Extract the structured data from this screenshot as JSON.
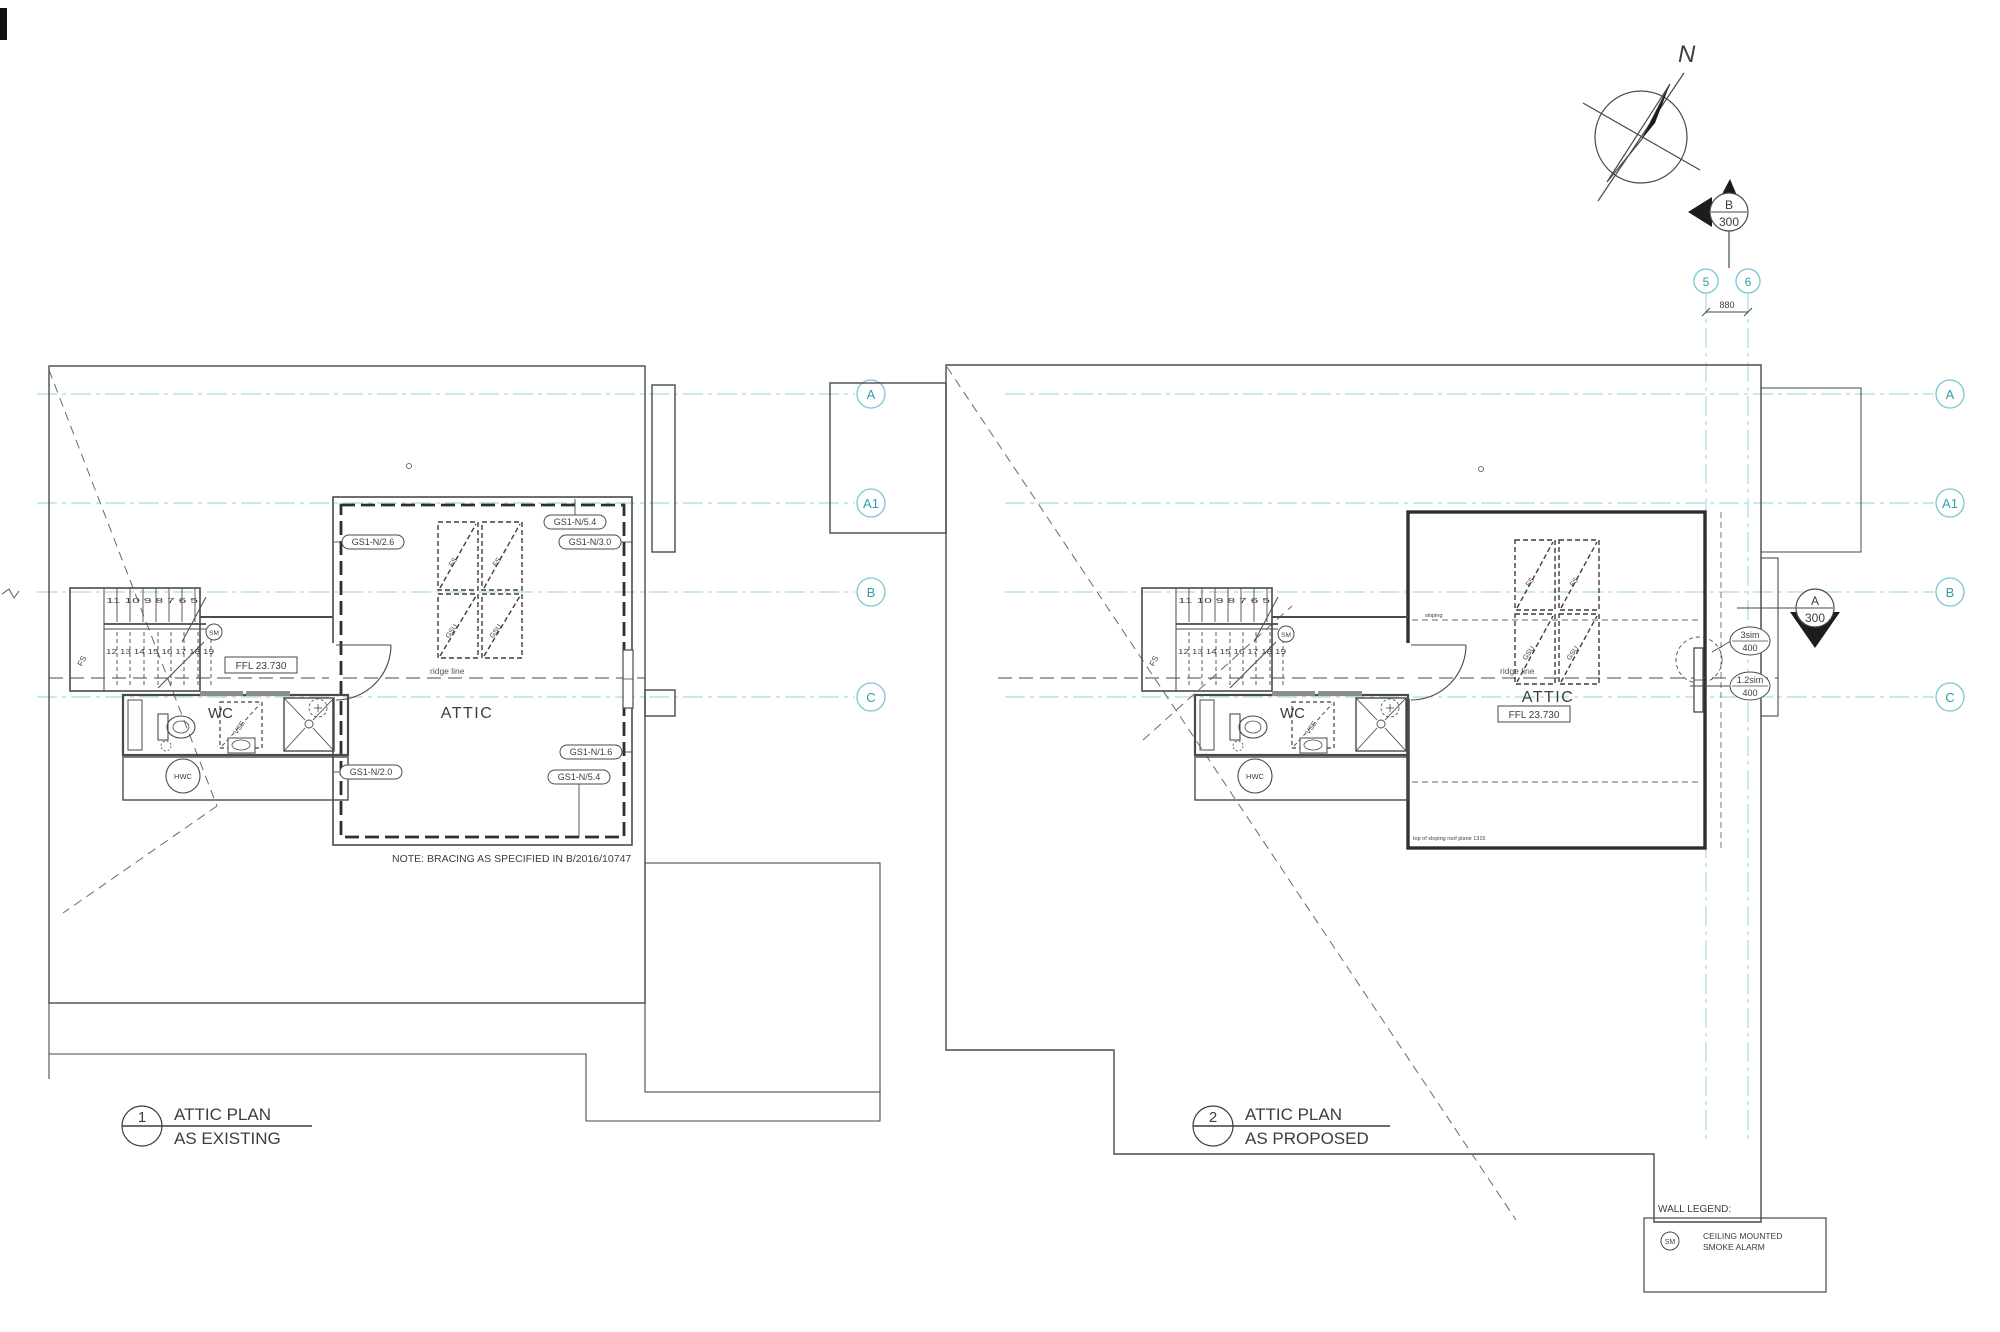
{
  "drawing": {
    "line_color": "#4a4a4a",
    "grid_line_color": "#a8dde2",
    "grid_bubble_color": "#79c7cf",
    "grid_text_color": "#2e9fae"
  },
  "north": {
    "label": "N"
  },
  "markers": {
    "b": {
      "letter": "B",
      "number": "300"
    },
    "a": {
      "letter": "A",
      "number": "300"
    }
  },
  "grids": {
    "horizontal": [
      {
        "label": "A"
      },
      {
        "label": "A1"
      },
      {
        "label": "B"
      },
      {
        "label": "C"
      }
    ],
    "vertical": [
      {
        "label": "5"
      },
      {
        "label": "6"
      }
    ],
    "dim_5_6": "880"
  },
  "plans": {
    "left": {
      "title_num": "1",
      "title_line1": "ATTIC PLAN",
      "title_line2": "AS EXISTING",
      "room": "ATTIC",
      "ffl": "FFL 23.730",
      "ridge": "ridge line",
      "wc": "WC",
      "hwc": "HWC",
      "sm": "SM",
      "stair_top": "11 10 9 8 7 6 5",
      "stair_bottom": "12 13 14 15 16 17 18 19",
      "stair_skylight": "FS",
      "skylight_fs": "FS",
      "skylight_gsu": "GSU",
      "wc_skylight": "VSE",
      "note": "NOTE: BRACING AS SPECIFIED IN B/2016/10747",
      "bracing_labels": {
        "left": "GS1-N/2.6",
        "top": "GS1-N/5.4",
        "right": "GS1-N/3.0",
        "bottom_right_upper": "GS1-N/1.6",
        "bottom_right_lower": "GS1-N/5.4",
        "bottom_left": "GS1-N/2.0"
      }
    },
    "right": {
      "title_num": "2",
      "title_line1": "ATTIC PLAN",
      "title_line2": "AS PROPOSED",
      "room": "ATTIC",
      "ffl": "FFL 23.730",
      "ridge": "ridge line",
      "wc": "WC",
      "hwc": "HWC",
      "sm": "SM",
      "stair_top": "11 10 9 8 7 6 5",
      "stair_bottom": "12 13 14 15 16 17 18 19",
      "stair_skylight": "FS",
      "skylight_fs": "FS",
      "skylight_gsu": "GSU",
      "wc_skylight": "VSE",
      "sloping_note": "sloping",
      "plate_note": "top of sloping roof plane 1315",
      "window_labels": {
        "upper_line1": "3sim",
        "upper_line2": "400",
        "lower_line1": "1.2sim",
        "lower_line2": "400"
      }
    }
  },
  "legend": {
    "title": "WALL LEGEND:",
    "sm": "SM",
    "item_line1": "CEILING MOUNTED",
    "item_line2": "SMOKE ALARM"
  }
}
